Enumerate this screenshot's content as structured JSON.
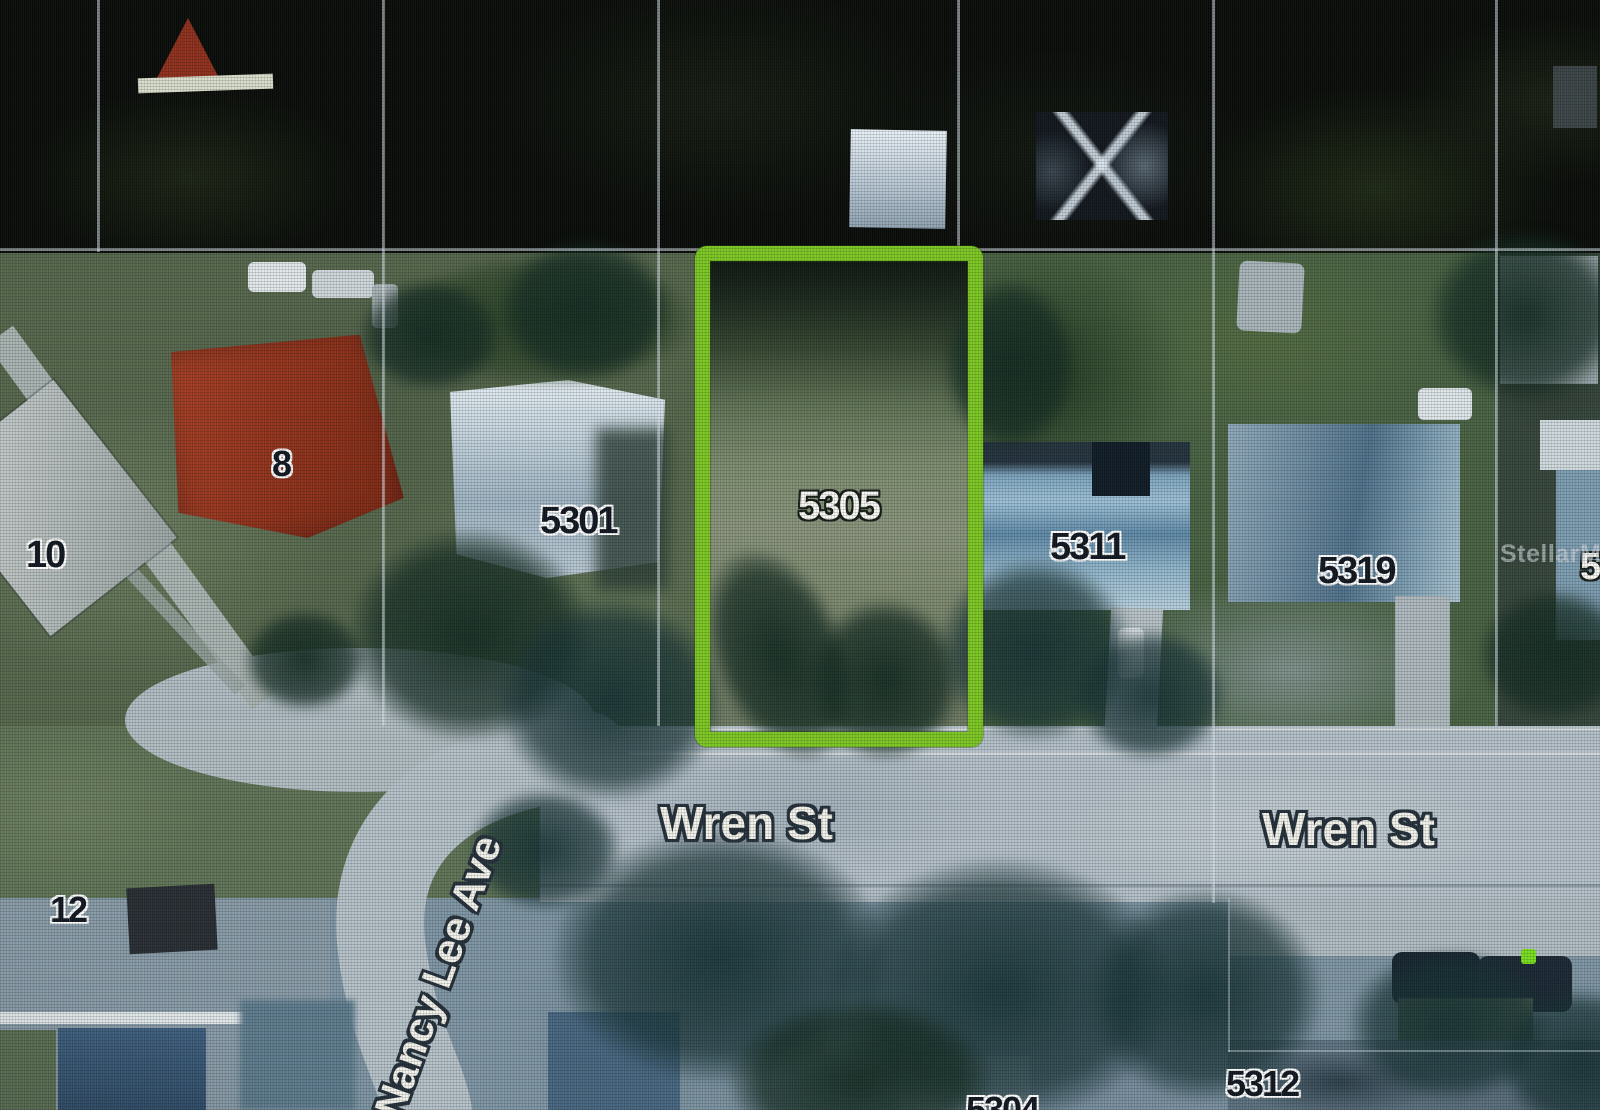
{
  "highlight": {
    "parcel": "5305",
    "outline_color": "#7cc621"
  },
  "watermark": "StellarMLS",
  "streets": {
    "wren_left": "Wren St",
    "wren_right": "Wren St",
    "nancy_lee": "Nancy Lee Ave"
  },
  "parcels": {
    "p8": "8",
    "p10": "10",
    "p12": "12",
    "p5301": "5301",
    "p5305": "5305",
    "p5311": "5311",
    "p5319": "5319",
    "p5304_partial": "5304",
    "p5312_partial": "5312",
    "p5_partial": "5"
  }
}
